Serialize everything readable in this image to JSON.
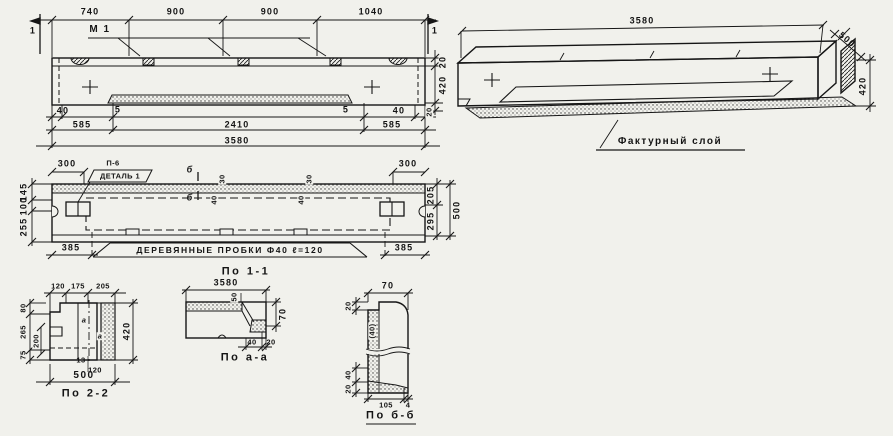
{
  "sheet": {
    "paper_color": "#f1f1ec",
    "ink_color": "#161616"
  },
  "elevation": {
    "flag_left": "1",
    "flag_right": "1",
    "loop_mark": "М 1",
    "dims_top": [
      "740",
      "900",
      "900",
      "1040"
    ],
    "dim_right_top": "20",
    "dim_right_mid": "420",
    "dim_right_bot": "20",
    "dims_row1": [
      "40",
      "5",
      "5",
      "40"
    ],
    "dims_row2": [
      "585",
      "2410",
      "585"
    ],
    "dim_total": "3580"
  },
  "axon": {
    "dim_length": "3580",
    "dim_width": "500",
    "dim_height": "420",
    "facture_label": "Фактурный слой"
  },
  "plan": {
    "dim_top_left": "300",
    "dim_top_right": "300",
    "label_p6": "П-6",
    "label_detail": "ДЕТАЛЬ 1",
    "section_letter_top": "б",
    "section_letter_bot": "б",
    "pair1": [
      "40",
      "30"
    ],
    "pair2": [
      "40",
      "30"
    ],
    "dims_left": [
      "145",
      "100",
      "255"
    ],
    "dims_right": [
      "205",
      "295"
    ],
    "dim_right_total": "500",
    "dim_bot_left": "385",
    "dim_bot_right": "385",
    "note": "ДЕРЕВЯННЫЕ ПРОБКИ Ф40 ℓ=120",
    "title": "По 1-1"
  },
  "section22": {
    "dims_top": [
      "120",
      "175",
      "205"
    ],
    "dims_left": [
      "80",
      "265",
      "75"
    ],
    "dim_inner": "200",
    "dim_right": "420",
    "letter_a1": "а",
    "letter_a2": "а",
    "dim_small1": "13",
    "dim_small2": "120",
    "dim_bottom": "500",
    "title": "По 2-2"
  },
  "sectionAA": {
    "dim_top": "3580",
    "dim_layer": "50",
    "dim_step": "70",
    "dim_b1": "40",
    "dim_b2": "20",
    "title": "По а-а"
  },
  "sectionBB": {
    "dim_top": "70",
    "dim_left_top": "20",
    "dim_mid": "(40)",
    "dim_left_b1": "40",
    "dim_left_b2": "20",
    "dim_bot1": "105",
    "dim_bot2": "4",
    "title": "По б-б"
  }
}
